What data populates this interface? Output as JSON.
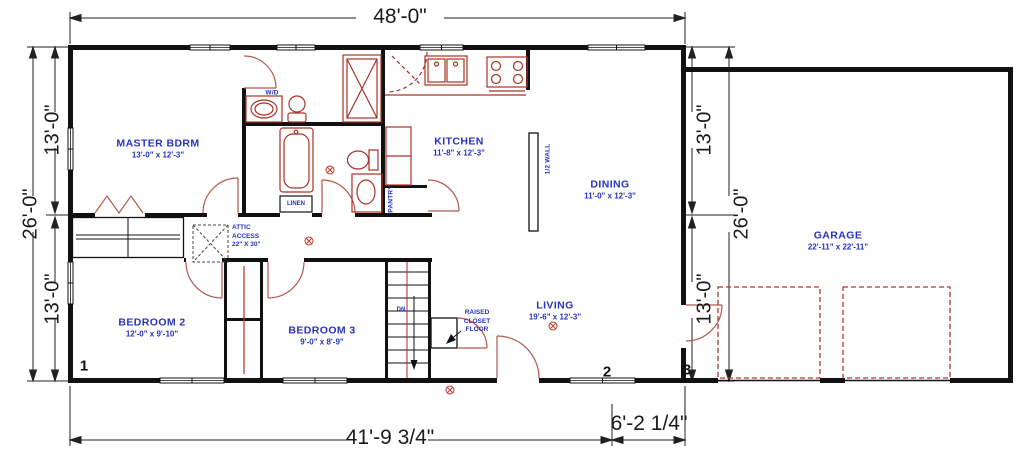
{
  "title": "Ranch floor plan",
  "dimensions": {
    "top": "48'-0\"",
    "left_total": "26'-0\"",
    "left_upper": "13'-0\"",
    "left_lower": "13'-0\"",
    "right_upper": "13'-0\"",
    "right_total": "26'-0\"",
    "right_lower": "13'-0\"",
    "bottom_main": "41'-9 3/4\"",
    "bottom_offset": "6'-2 1/4\""
  },
  "rooms": {
    "master": {
      "name": "MASTER BDRM",
      "size": "13'-0\" x 12'-3\""
    },
    "kitchen": {
      "name": "KITCHEN",
      "size": "11'-8\" x 12'-3\""
    },
    "dining": {
      "name": "DINING",
      "size": "11'-0\" x 12'-3\""
    },
    "garage": {
      "name": "GARAGE",
      "size": "22'-11\" x 22'-11\""
    },
    "bedroom2": {
      "name": "BEDROOM 2",
      "size": "12'-0\" x 9'-10\""
    },
    "bedroom3": {
      "name": "BEDROOM 3",
      "size": "9'-0\" x 8'-9\""
    },
    "living": {
      "name": "LIVING",
      "size": "19'-6\" x 12'-3\""
    }
  },
  "labels": {
    "wd": "W/D",
    "linen": "LINEN",
    "pantry": "PANTRY",
    "half_wall": "1/2 WALL",
    "dn": "DN",
    "attic1": "ATTIC",
    "attic2": "ACCESS",
    "attic3": "22\" X 30\"",
    "raised1": "RAISED",
    "raised2": "CLOSET",
    "raised3": "FLOOR"
  },
  "markers": {
    "m1": "1",
    "m2": "2",
    "m3": "3"
  },
  "colors": {
    "wall": "#111111",
    "red": "#a93226",
    "arc": "#b4574a",
    "blue": "#2733c0"
  }
}
